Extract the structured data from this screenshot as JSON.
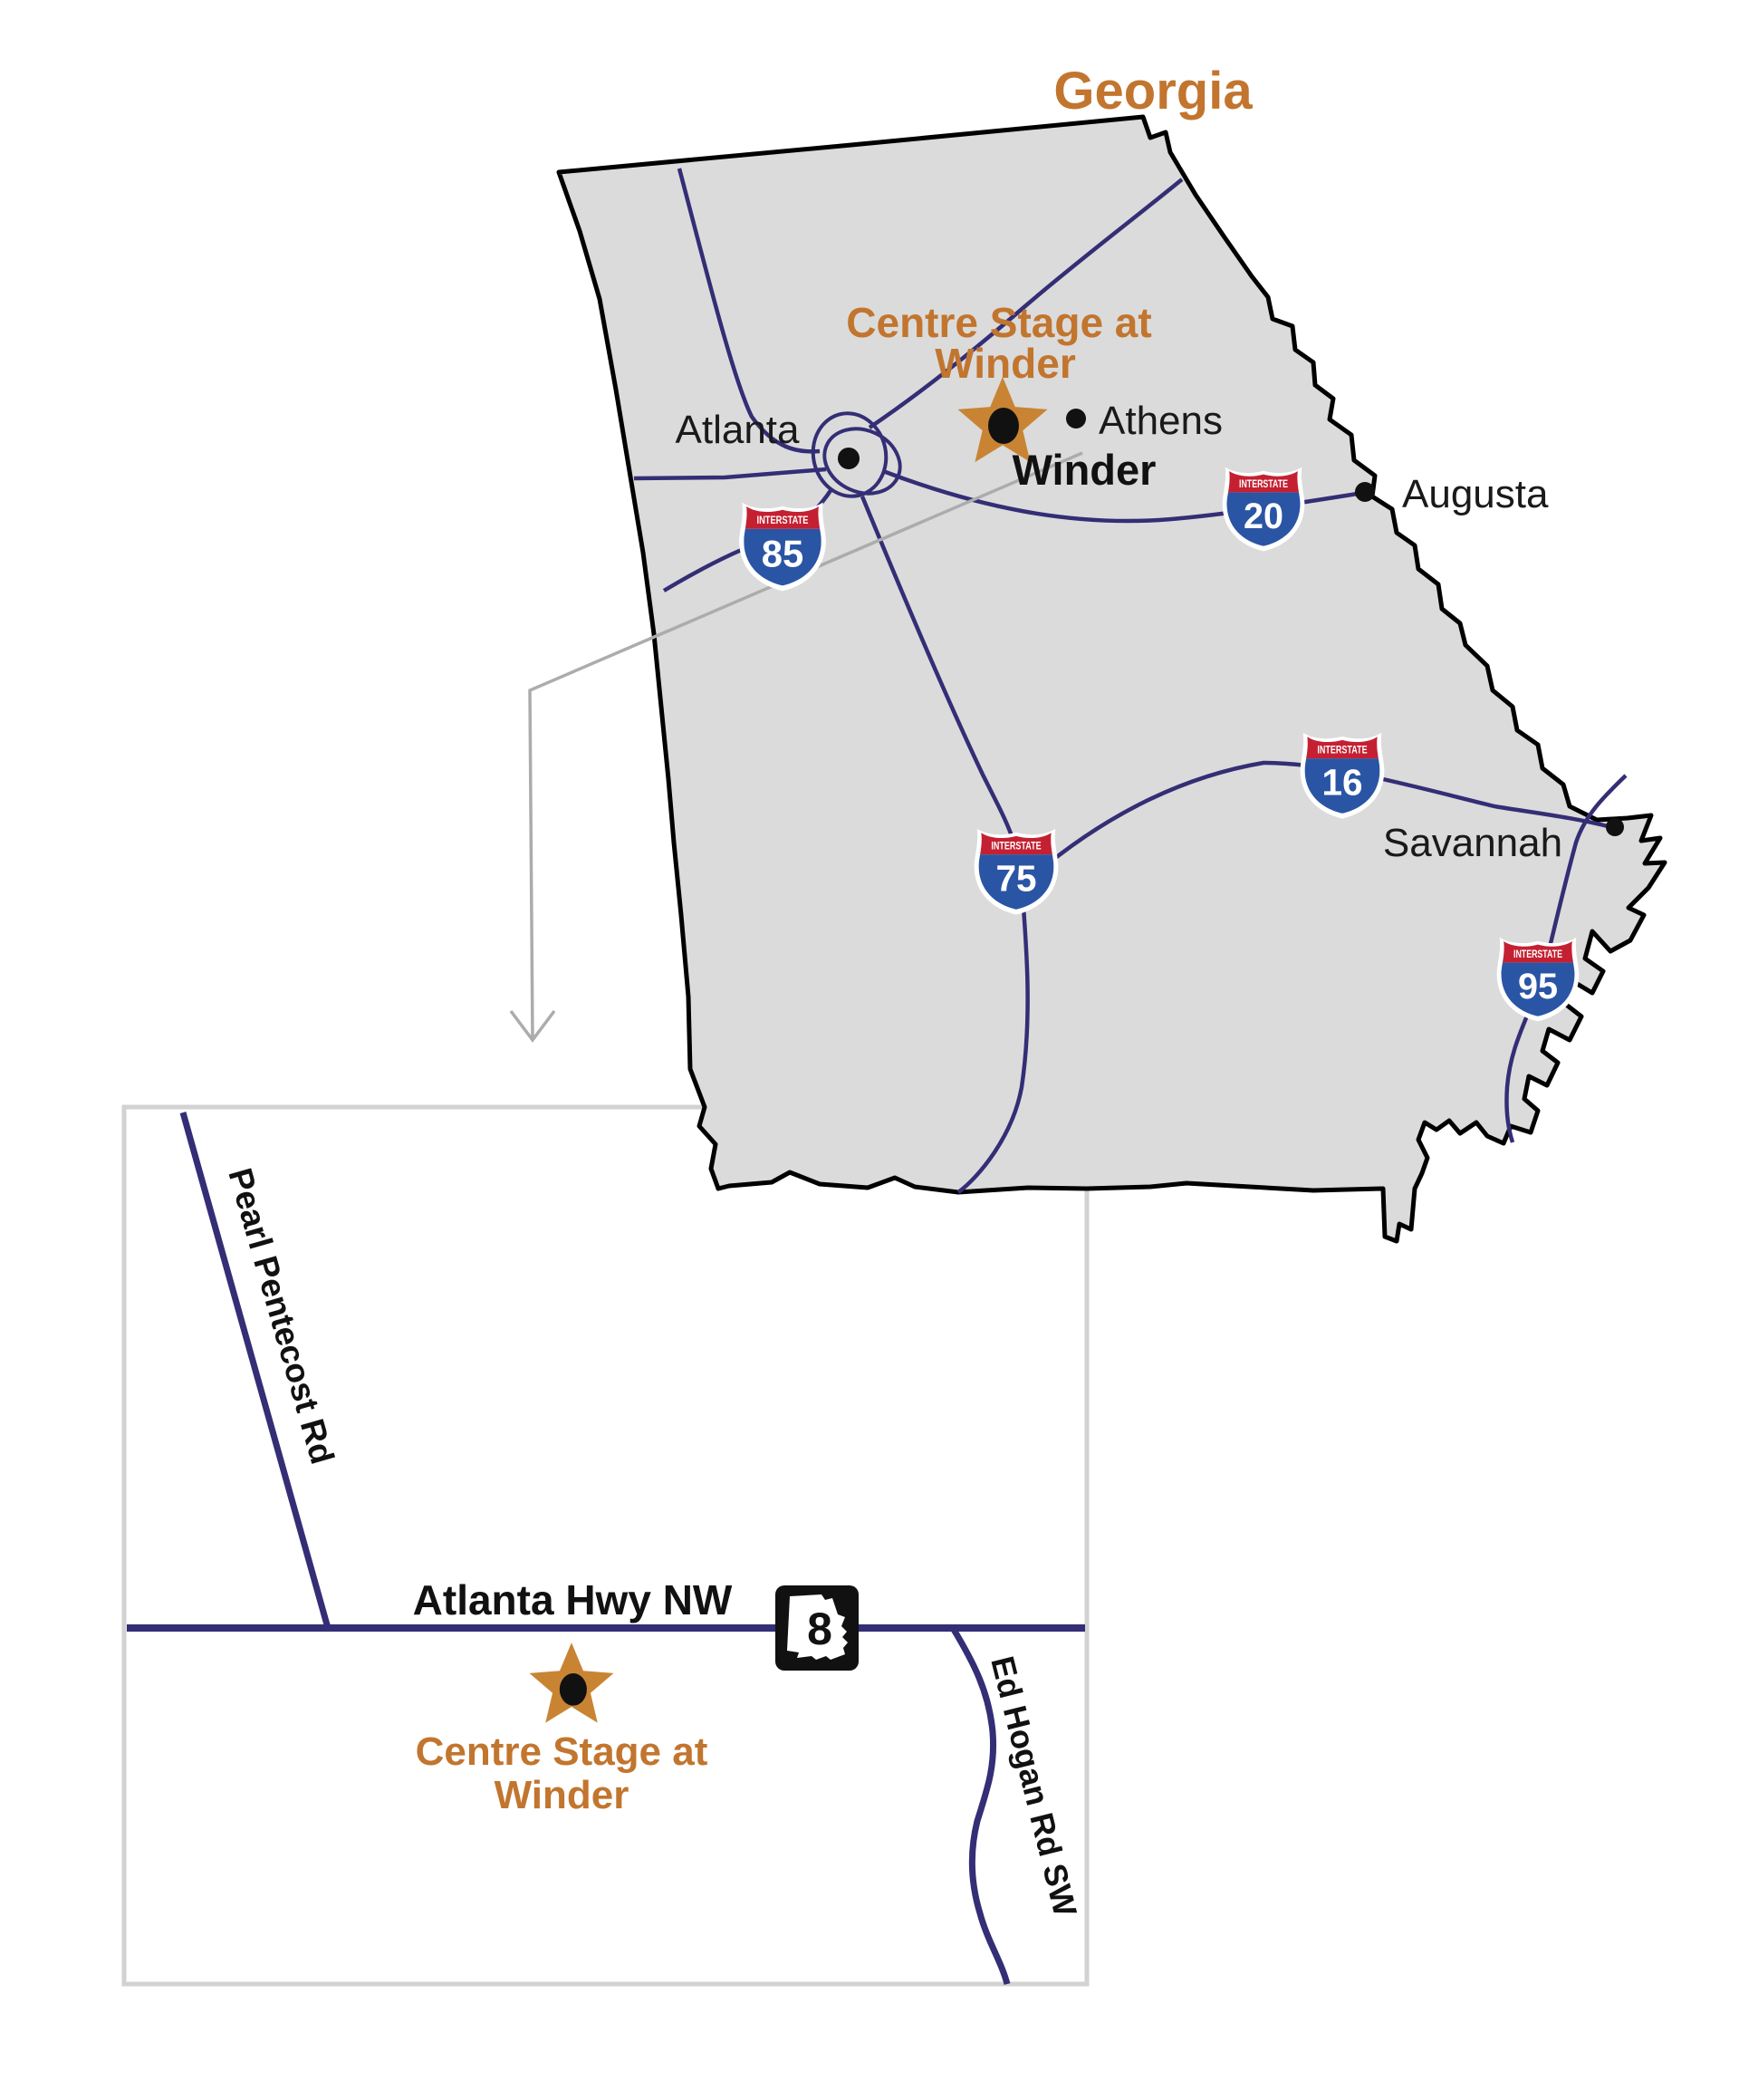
{
  "title": "Georgia",
  "colors": {
    "accent_orange": "#C2752E",
    "star_orange": "#C98433",
    "state_fill": "#DBDBDB",
    "state_border": "#000000",
    "road_navy": "#332E75",
    "shield_red": "#C42032",
    "shield_blue": "#2A55A4",
    "callout_gray": "#ACACAC",
    "inset_border": "#D2D2D2",
    "ga_route_black": "#111111"
  },
  "state_map": {
    "venue": {
      "line1": "Centre Stage at",
      "line2": "Winder",
      "city_label": "Winder"
    },
    "cities": [
      {
        "name": "Atlanta"
      },
      {
        "name": "Athens"
      },
      {
        "name": "Augusta"
      },
      {
        "name": "Savannah"
      }
    ],
    "interstates": [
      {
        "number": "85",
        "label": "INTERSTATE"
      },
      {
        "number": "20",
        "label": "INTERSTATE"
      },
      {
        "number": "75",
        "label": "INTERSTATE"
      },
      {
        "number": "16",
        "label": "INTERSTATE"
      },
      {
        "number": "95",
        "label": "INTERSTATE"
      }
    ]
  },
  "inset_map": {
    "roads": [
      {
        "name": "Pearl Pentecost Rd"
      },
      {
        "name": "Atlanta Hwy NW"
      },
      {
        "name": "Ed Hogan Rd SW"
      }
    ],
    "state_route": {
      "number": "8"
    },
    "venue": {
      "line1": "Centre Stage at",
      "line2": "Winder"
    }
  }
}
